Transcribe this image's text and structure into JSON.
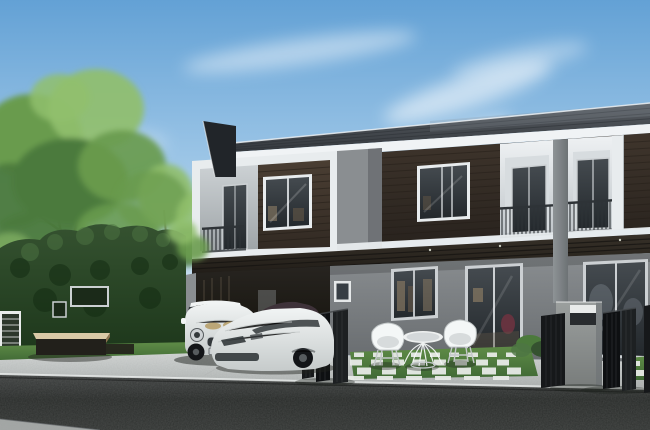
{
  "scene": {
    "description": "Architectural rendering of a modern two-storey townhouse row with dark wood siding, white trim frames, recessed balconies, a carport with two white cars, a green hedge wall with signage, patio with white wire chairs and table on checkerboard grass pavers, mailbox pillar, dark folding gates, sidewalk and asphalt street under a blue sky with wispy clouds"
  },
  "colors": {
    "sky_top": "#63a1d5",
    "sky_mid": "#a8cdea",
    "sky_low": "#ddeaf5",
    "cloud": "#ffffff",
    "roof_top": "#585d63",
    "roof_bot": "#35393e",
    "roof_line": "#2b2f34",
    "ridge": "#edf1f4",
    "roof_sheen": "#8a939b",
    "fascia": "#f0f3f5",
    "fin": "#212529",
    "frame": "#e8ecee",
    "wl_top": "#ccd1d4",
    "wl_bot": "#9ea4a7",
    "sd1_top": "#4a3e33",
    "sd1_bot": "#322a23",
    "sd_line": "#241e18",
    "sd2_top": "#3f352c",
    "sd2_bot": "#29231e",
    "glass_top": "#454b50",
    "glass_bot": "#23282c",
    "glass_frame": "#ccd0d3",
    "railing": "#2e3337",
    "bal_top": "#eef1f3",
    "bal_bot": "#bfc5c9",
    "bal_back": "#d7dcdf",
    "pillar_top": "#8e9396",
    "pillar_bot": "#6d7275",
    "ped_top": "#9b9f9e",
    "ped_bot": "#797d7c",
    "awn_top": "#373129",
    "awn_bot": "#1f1b16",
    "awn_line": "#141210",
    "downlight": "#d8dcce",
    "wm_top": "#8a8e91",
    "wm_bot": "#686c6f",
    "cp_top": "#272420",
    "cp_bot": "#121009",
    "warm1": "#80735f",
    "warm2": "#5c5245",
    "maroon": "#6d3340",
    "hedge_top": "#355230",
    "hedge_bot": "#1d371b",
    "hedge_lt": "#4e7543",
    "hedge_dk": "#122a11",
    "tree_lt": "#90bf6c",
    "tree_md": "#699b4e",
    "tree_dk": "#4c7a3c",
    "trunk": "#4e453b",
    "grass_top": "#5f8c47",
    "grass_bot": "#406935",
    "paver": "#e8ebe7",
    "sw_top": "#d4d7d6",
    "sw_bot": "#b0b4b3",
    "curb": "#eaedec",
    "road_top": "#474a49",
    "road_mid": "#2e312f",
    "road_bot": "#383b39",
    "road_strip": "#b5b9b7",
    "gate_a": "#16181a",
    "gate_b": "#0e1012",
    "gate_c": "#1d2022",
    "gate_hl": "#45494c",
    "car": "#f1f4f4",
    "car_shade": "#c6cbcb",
    "car_glass": "#33383b",
    "wheel": "#131518",
    "hub": "#565b5e",
    "vent": "#b7a06c",
    "car2_roof": "#3e3239",
    "chair": "#f4f7f7",
    "chair_line": "#c3c8c9",
    "bench_top": "#d9c9a6",
    "bench_side": "#8a7350",
    "bench_body": "#22201b",
    "lat_frame": "#e9eceb",
    "lat_dark": "#2c372b",
    "mb_face": "#e9ebea",
    "mb_dark": "#292c2f",
    "pic_frame": "#e5e8e9",
    "pic_dark": "#373e44",
    "sign_frame": "#cbd0d2",
    "sign_dark": "#1b2a19",
    "hl": "#ffffff",
    "ink": "#000000",
    "shadow": "#1e221d"
  }
}
